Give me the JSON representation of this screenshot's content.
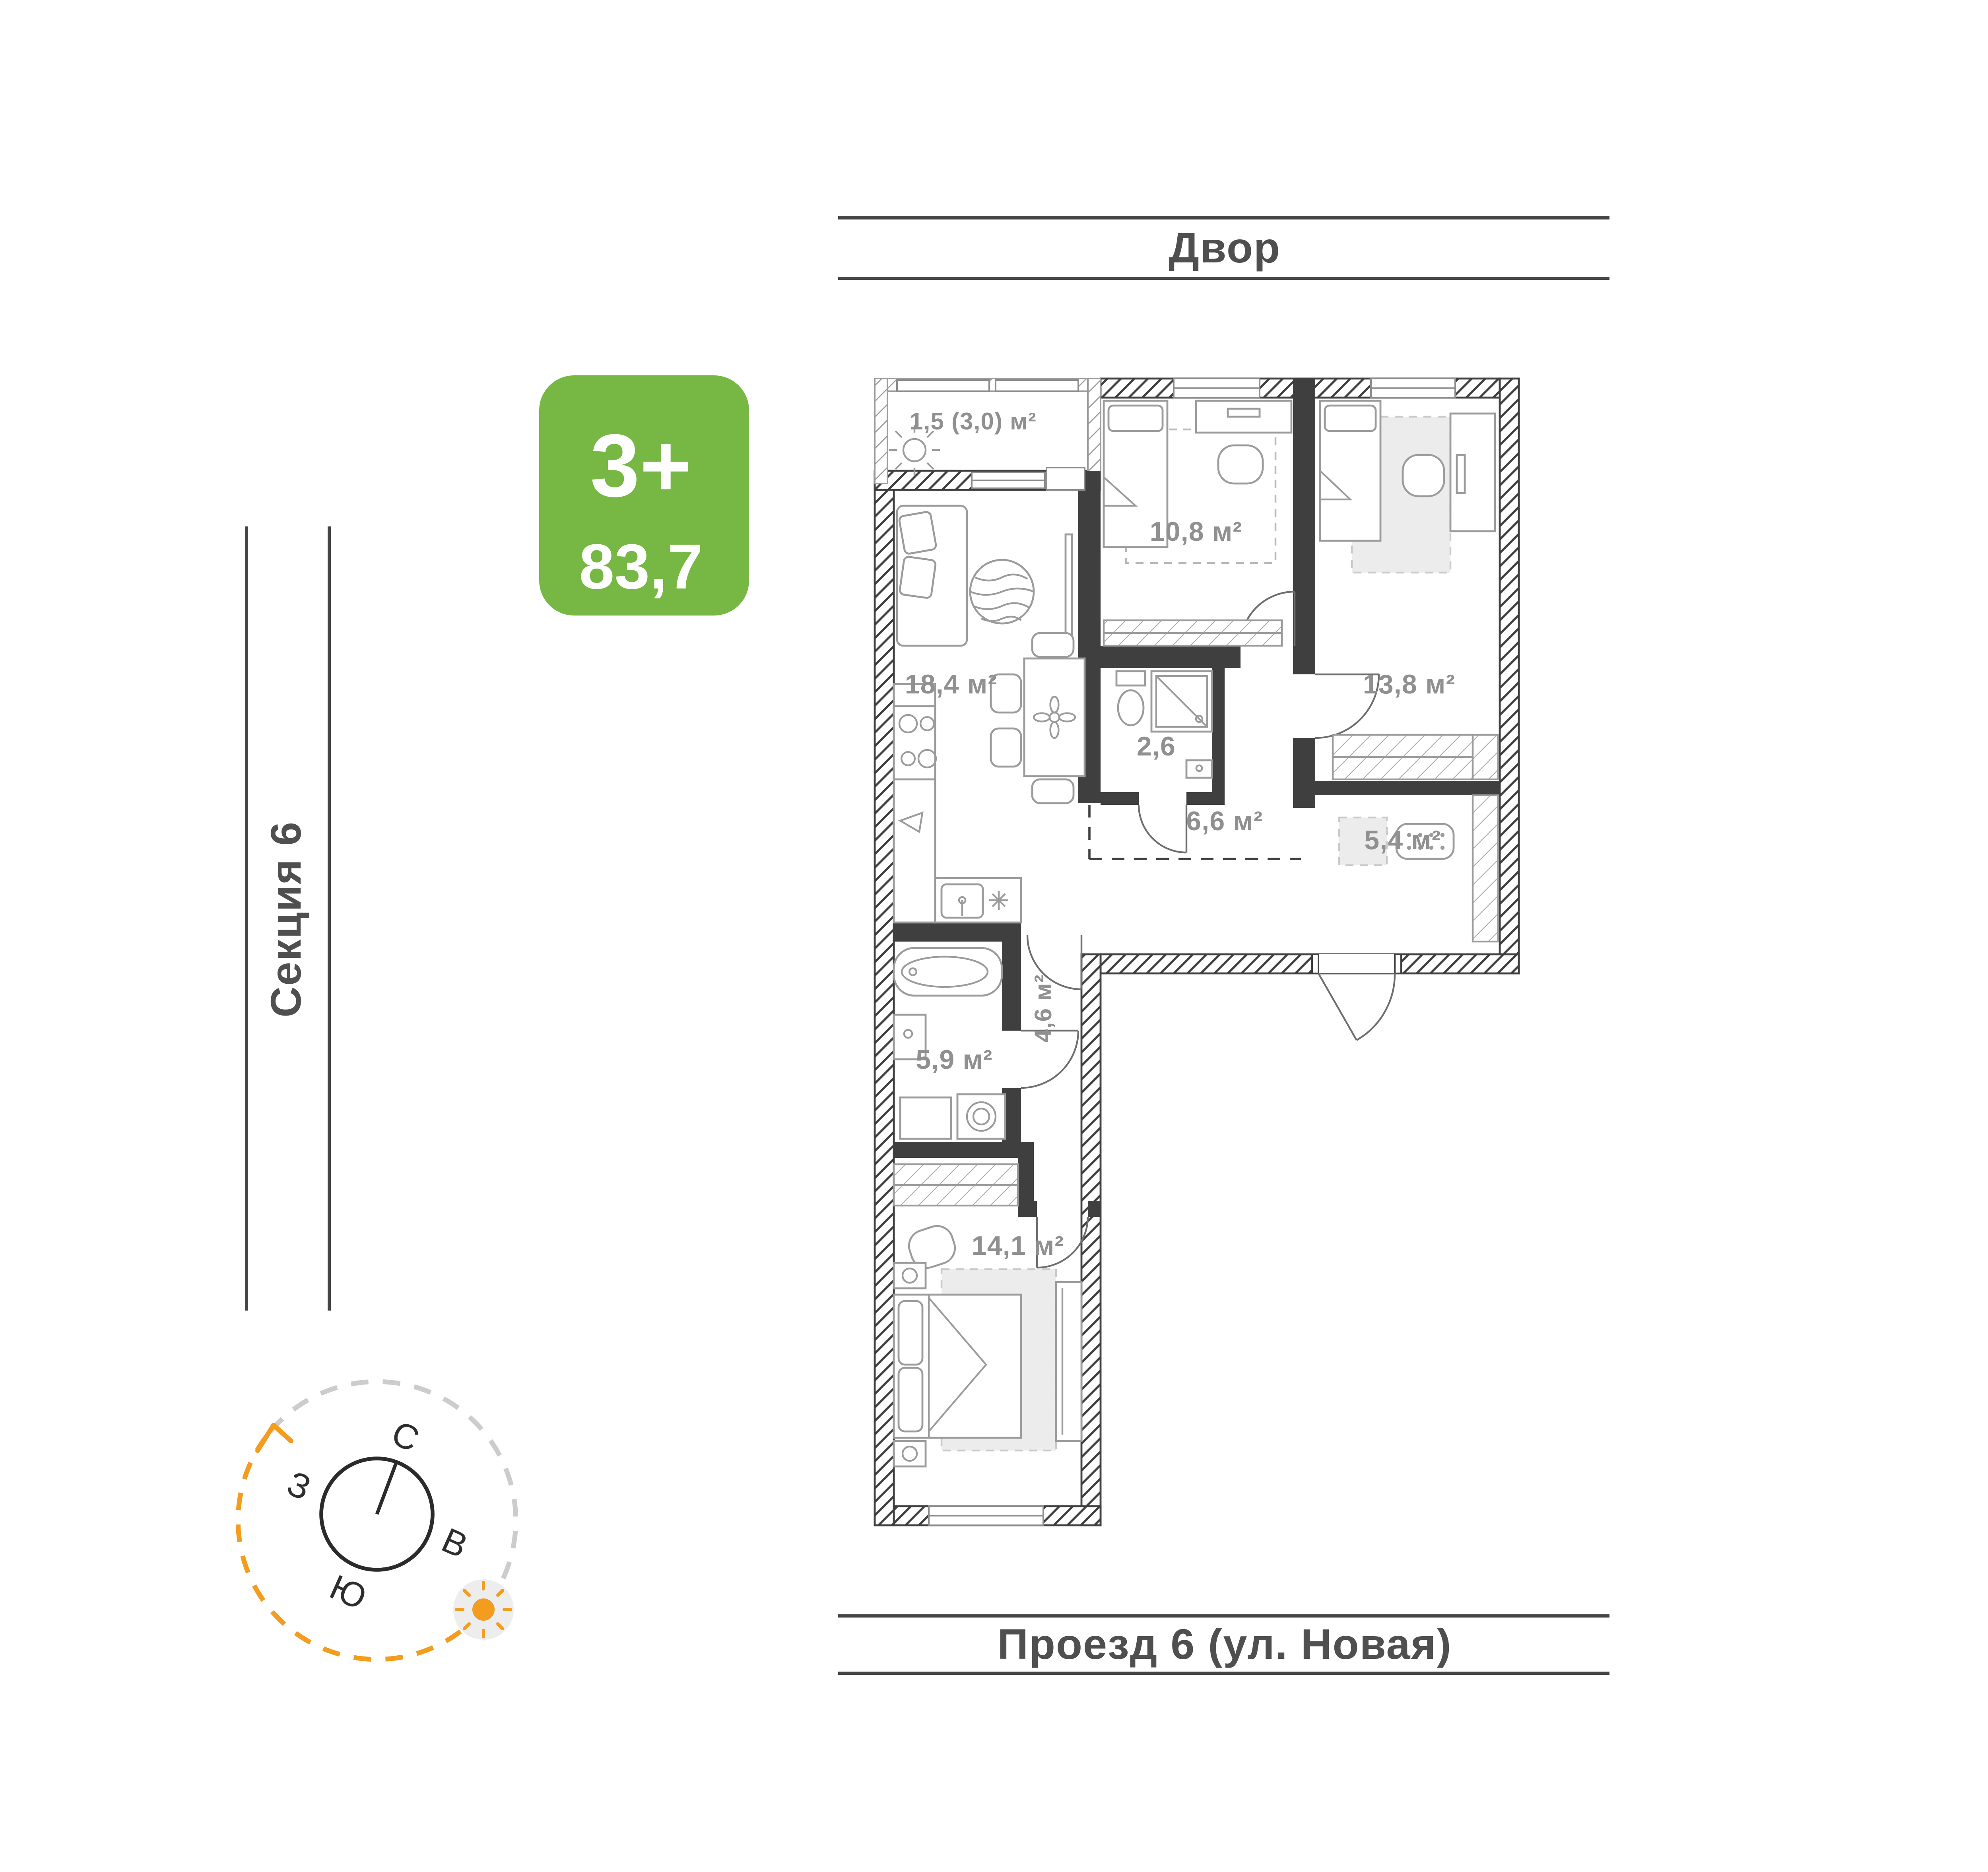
{
  "badge": {
    "rooms_type": "3+",
    "total_area": "83,7"
  },
  "surroundings": {
    "top": "Двор",
    "left": "Секция 6",
    "right": "Проезд 8 (ул. Новая)",
    "bottom": "Проезд 6 (ул. Новая)"
  },
  "compass": {
    "north": "С",
    "south": "Ю",
    "west": "З",
    "east": "В"
  },
  "plan": {
    "rooms": [
      {
        "id": "balcony",
        "area": "1,5 (3,0) м²"
      },
      {
        "id": "living_kitchen",
        "area": "18,4 м²"
      },
      {
        "id": "bedroom_child",
        "area": "10,8 м²"
      },
      {
        "id": "bedroom_large",
        "area": "13,8 м²"
      },
      {
        "id": "wc",
        "area": "2,6"
      },
      {
        "id": "hallway",
        "area": "6,6 м²"
      },
      {
        "id": "dressing_room",
        "area": "5,4 м²"
      },
      {
        "id": "corridor",
        "area": "4,6 м²"
      },
      {
        "id": "bathroom",
        "area": "5,9 м²"
      },
      {
        "id": "bedroom_master",
        "area": "14,1 м²"
      }
    ]
  },
  "colors": {
    "badge_green": "#76b843",
    "area_label_gray": "#909090",
    "wall_dark": "#3f3f3f",
    "street_text_gray": "#4f4f4f",
    "accent_orange": "#f39c1d",
    "rug_gray": "#ececec"
  }
}
